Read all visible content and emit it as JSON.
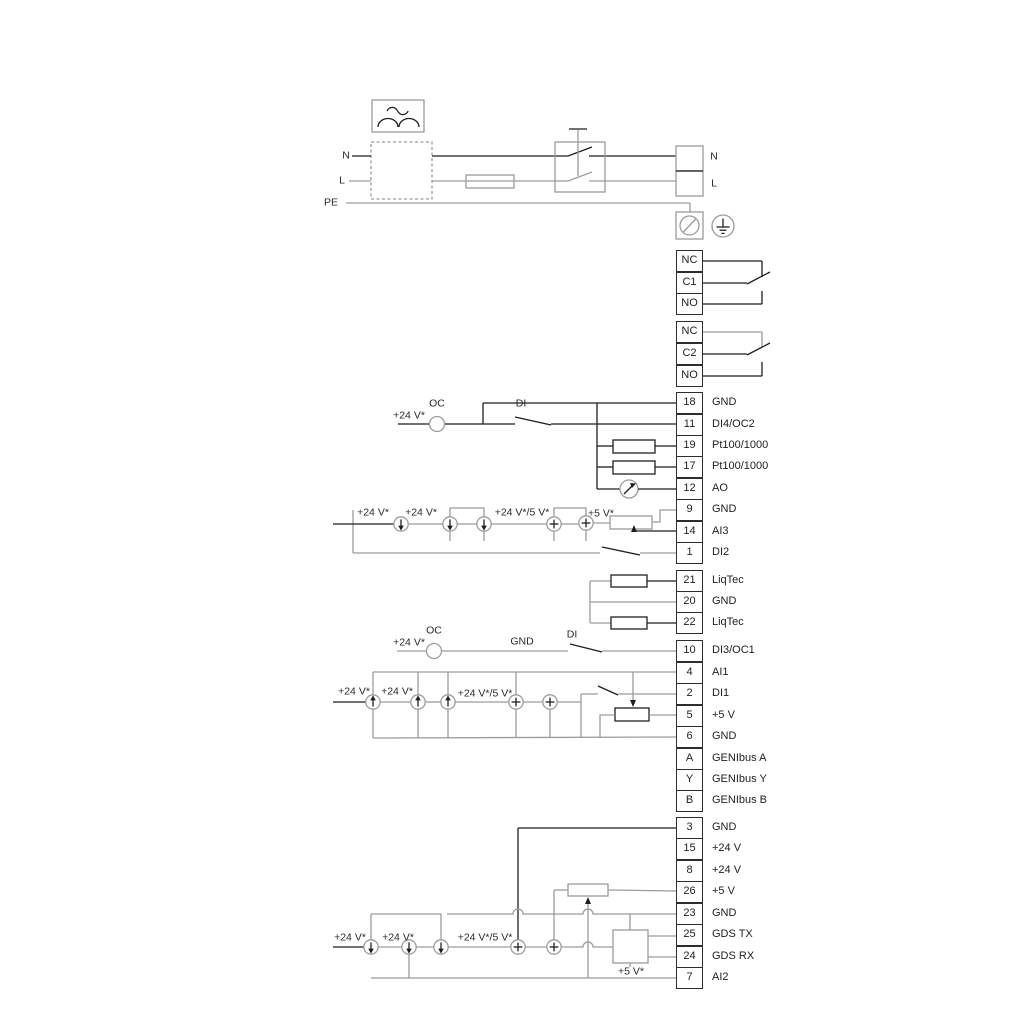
{
  "power": {
    "n_in": "N",
    "l_in": "L",
    "pe": "PE",
    "n_out": "N",
    "l_out": "L"
  },
  "relays": [
    [
      "NC",
      "C1",
      "NO"
    ],
    [
      "NC",
      "C2",
      "NO"
    ]
  ],
  "terminals": [
    {
      "id": "18",
      "label": "GND"
    },
    {
      "id": "11",
      "label": "DI4/OC2"
    },
    {
      "id": "19",
      "label": "Pt100/1000"
    },
    {
      "id": "17",
      "label": "Pt100/1000"
    },
    {
      "id": "12",
      "label": "AO"
    },
    {
      "id": "9",
      "label": "GND"
    },
    {
      "id": "14",
      "label": "AI3"
    },
    {
      "id": "1",
      "label": "DI2"
    },
    {
      "id": "21",
      "label": "LiqTec"
    },
    {
      "id": "20",
      "label": "GND"
    },
    {
      "id": "22",
      "label": "LiqTec"
    },
    {
      "id": "10",
      "label": "DI3/OC1"
    },
    {
      "id": "4",
      "label": "AI1"
    },
    {
      "id": "2",
      "label": "DI1"
    },
    {
      "id": "5",
      "label": "+5 V"
    },
    {
      "id": "6",
      "label": "GND"
    },
    {
      "id": "A",
      "label": "GENIbus A"
    },
    {
      "id": "Y",
      "label": "GENIbus Y"
    },
    {
      "id": "B",
      "label": "GENIbus B"
    },
    {
      "id": "3",
      "label": "GND"
    },
    {
      "id": "15",
      "label": "+24 V"
    },
    {
      "id": "8",
      "label": "+24 V"
    },
    {
      "id": "26",
      "label": "+5 V"
    },
    {
      "id": "23",
      "label": "GND"
    },
    {
      "id": "25",
      "label": "GDS TX"
    },
    {
      "id": "24",
      "label": "GDS RX"
    },
    {
      "id": "7",
      "label": "AI2"
    }
  ],
  "annotations": {
    "v24": "+24 V*",
    "v24_5": "+24 V*/5 V*",
    "v5": "+5 V*",
    "oc": "OC",
    "di": "DI",
    "gnd": "GND"
  },
  "colors": {
    "wire_gray": "#9c9c9c",
    "wire_dark": "#1f1f1f"
  }
}
